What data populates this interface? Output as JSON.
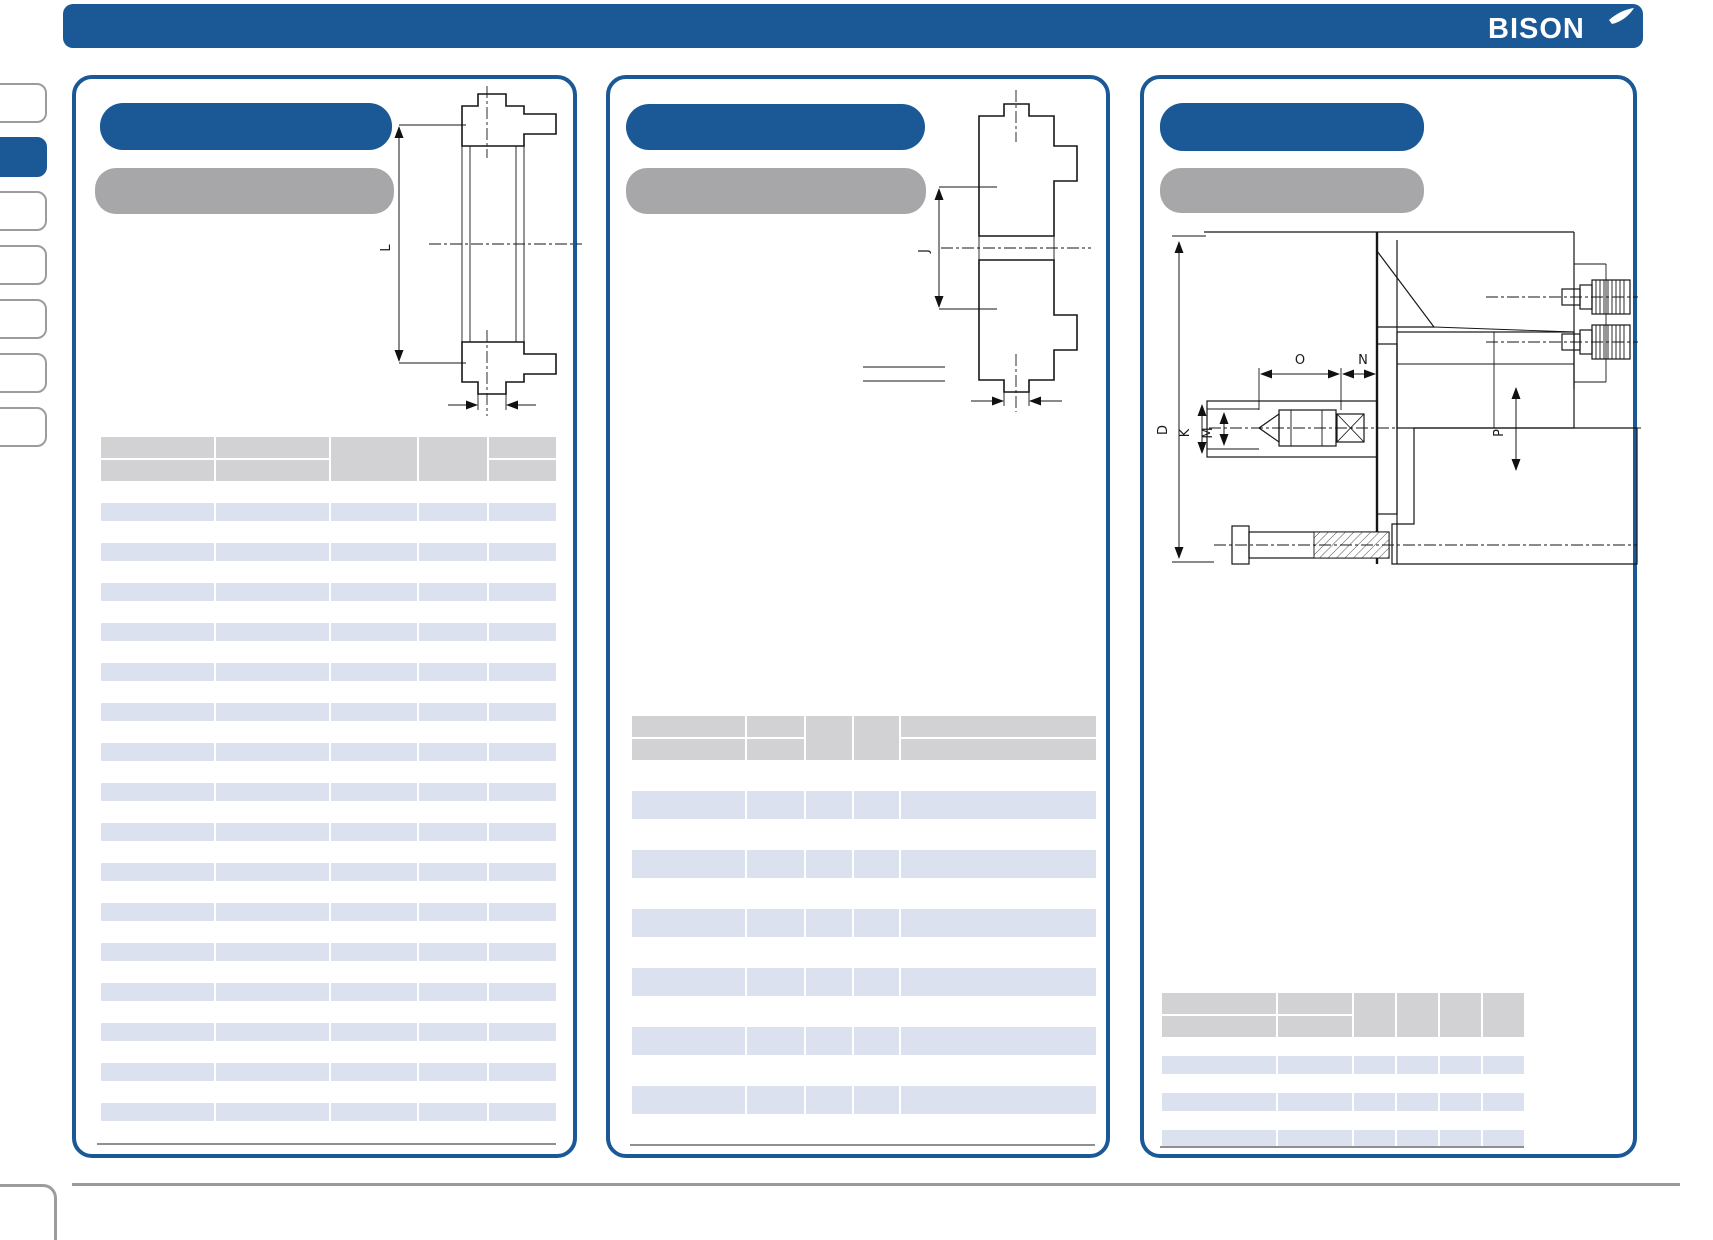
{
  "header": {
    "logo_text": "BISON",
    "bar_color": "#1a5896"
  },
  "sidebar": {
    "tabs": [
      {
        "label": "",
        "active": false
      },
      {
        "label": "",
        "active": true
      },
      {
        "label": "",
        "active": false
      },
      {
        "label": "",
        "active": false
      },
      {
        "label": "",
        "active": false
      },
      {
        "label": "",
        "active": false
      },
      {
        "label": "",
        "active": false
      }
    ]
  },
  "panels": [
    {
      "title": "",
      "subtitle": "",
      "drawing": {
        "type": "backplate-cross-section",
        "labels": {
          "L": "L"
        }
      },
      "table": {
        "pattern": [
          "split",
          "split",
          "merged",
          "merged",
          "split"
        ],
        "rows": [
          [
            "",
            "",
            "",
            "",
            ""
          ],
          [
            "",
            "",
            "",
            "",
            ""
          ],
          [
            "",
            "",
            "",
            "",
            ""
          ],
          [
            "",
            "",
            "",
            "",
            ""
          ],
          [
            "",
            "",
            "",
            "",
            ""
          ],
          [
            "",
            "",
            "",
            "",
            ""
          ],
          [
            "",
            "",
            "",
            "",
            ""
          ],
          [
            "",
            "",
            "",
            "",
            ""
          ],
          [
            "",
            "",
            "",
            "",
            ""
          ],
          [
            "",
            "",
            "",
            "",
            ""
          ],
          [
            "",
            "",
            "",
            "",
            ""
          ],
          [
            "",
            "",
            "",
            "",
            ""
          ],
          [
            "",
            "",
            "",
            "",
            ""
          ],
          [
            "",
            "",
            "",
            "",
            ""
          ],
          [
            "",
            "",
            "",
            "",
            ""
          ],
          [
            "",
            "",
            "",
            "",
            ""
          ]
        ]
      }
    },
    {
      "title": "",
      "subtitle": "",
      "drawing": {
        "type": "backplate-cross-section",
        "labels": {
          "J": "J"
        }
      },
      "table": {
        "pattern": [
          "split",
          "split",
          "merged",
          "merged",
          "split"
        ],
        "rows": [
          [
            "",
            "",
            "",
            "",
            ""
          ],
          [
            "",
            "",
            "",
            "",
            ""
          ],
          [
            "",
            "",
            "",
            "",
            ""
          ],
          [
            "",
            "",
            "",
            "",
            ""
          ],
          [
            "",
            "",
            "",
            "",
            ""
          ],
          [
            "",
            "",
            "",
            "",
            ""
          ]
        ]
      }
    },
    {
      "title": "",
      "subtitle": "",
      "drawing": {
        "type": "chuck-mounting-assembly-section",
        "labels": {
          "D": "D",
          "K": "K",
          "M": "M",
          "O": "O",
          "N": "N",
          "P": "P"
        }
      },
      "table": {
        "pattern": [
          "split",
          "split",
          "merged",
          "merged",
          "merged",
          "merged"
        ],
        "rows": [
          [
            "",
            "",
            "",
            "",
            "",
            ""
          ],
          [
            "",
            "",
            "",
            "",
            "",
            ""
          ],
          [
            "",
            "",
            "",
            "",
            "",
            ""
          ]
        ]
      }
    }
  ],
  "colors": {
    "brand_blue": "#1a5896",
    "subtitle_gray": "#a7a7a9",
    "table_header_gray": "#d2d2d4",
    "table_row_lavender": "#dce1ef",
    "hairline_gray": "#8f8f8f"
  }
}
